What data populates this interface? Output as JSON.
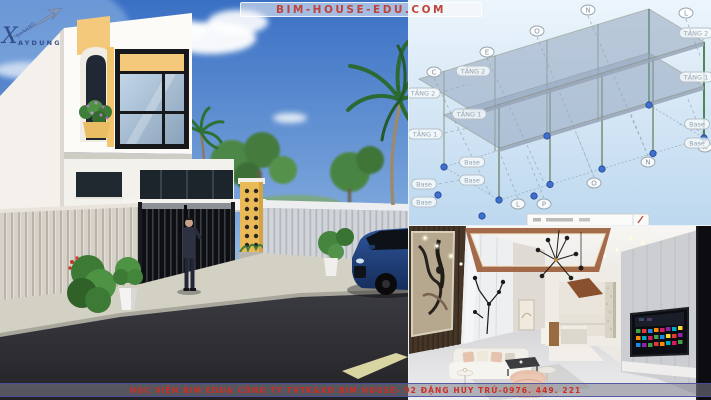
{
  "header": {
    "site_badge": "BIM-HOUSE-EDU.COM"
  },
  "footer": {
    "banner_text": "HỌC VIỆN BIM EDU& CÔNG TY TVTK&XD BIM HOUSE- 92 ĐẶNG HUY TRỨ-0976. 449. 221"
  },
  "logo": {
    "initial": "X",
    "word": "AYDUNG",
    "arrow_label": "DANANG"
  },
  "bim_view": {
    "grid_bubbles": [
      {
        "label": "C"
      },
      {
        "label": "E"
      },
      {
        "label": "O"
      },
      {
        "label": "N"
      },
      {
        "label": "L"
      },
      {
        "label": "L"
      },
      {
        "label": "P"
      },
      {
        "label": "O"
      },
      {
        "label": "N"
      },
      {
        "label": "K"
      }
    ],
    "level_tags": [
      {
        "label": "TẦNG 2"
      },
      {
        "label": "TẦNG 2"
      },
      {
        "label": "TẦNG 2"
      },
      {
        "label": "TẦNG 1"
      },
      {
        "label": "TẦNG 1"
      },
      {
        "label": "TẦNG 1"
      },
      {
        "label": "Base"
      },
      {
        "label": "Base"
      },
      {
        "label": "Base"
      },
      {
        "label": "Base"
      },
      {
        "label": "Base"
      },
      {
        "label": "Base"
      }
    ]
  },
  "colors": {
    "brand_red": "#c0392b",
    "accent_yellow": "#f2c472",
    "sky_blue_top": "#3a70c4",
    "bim_node_blue": "#3f6fd0",
    "copper_ceiling": "#9a5c38"
  }
}
